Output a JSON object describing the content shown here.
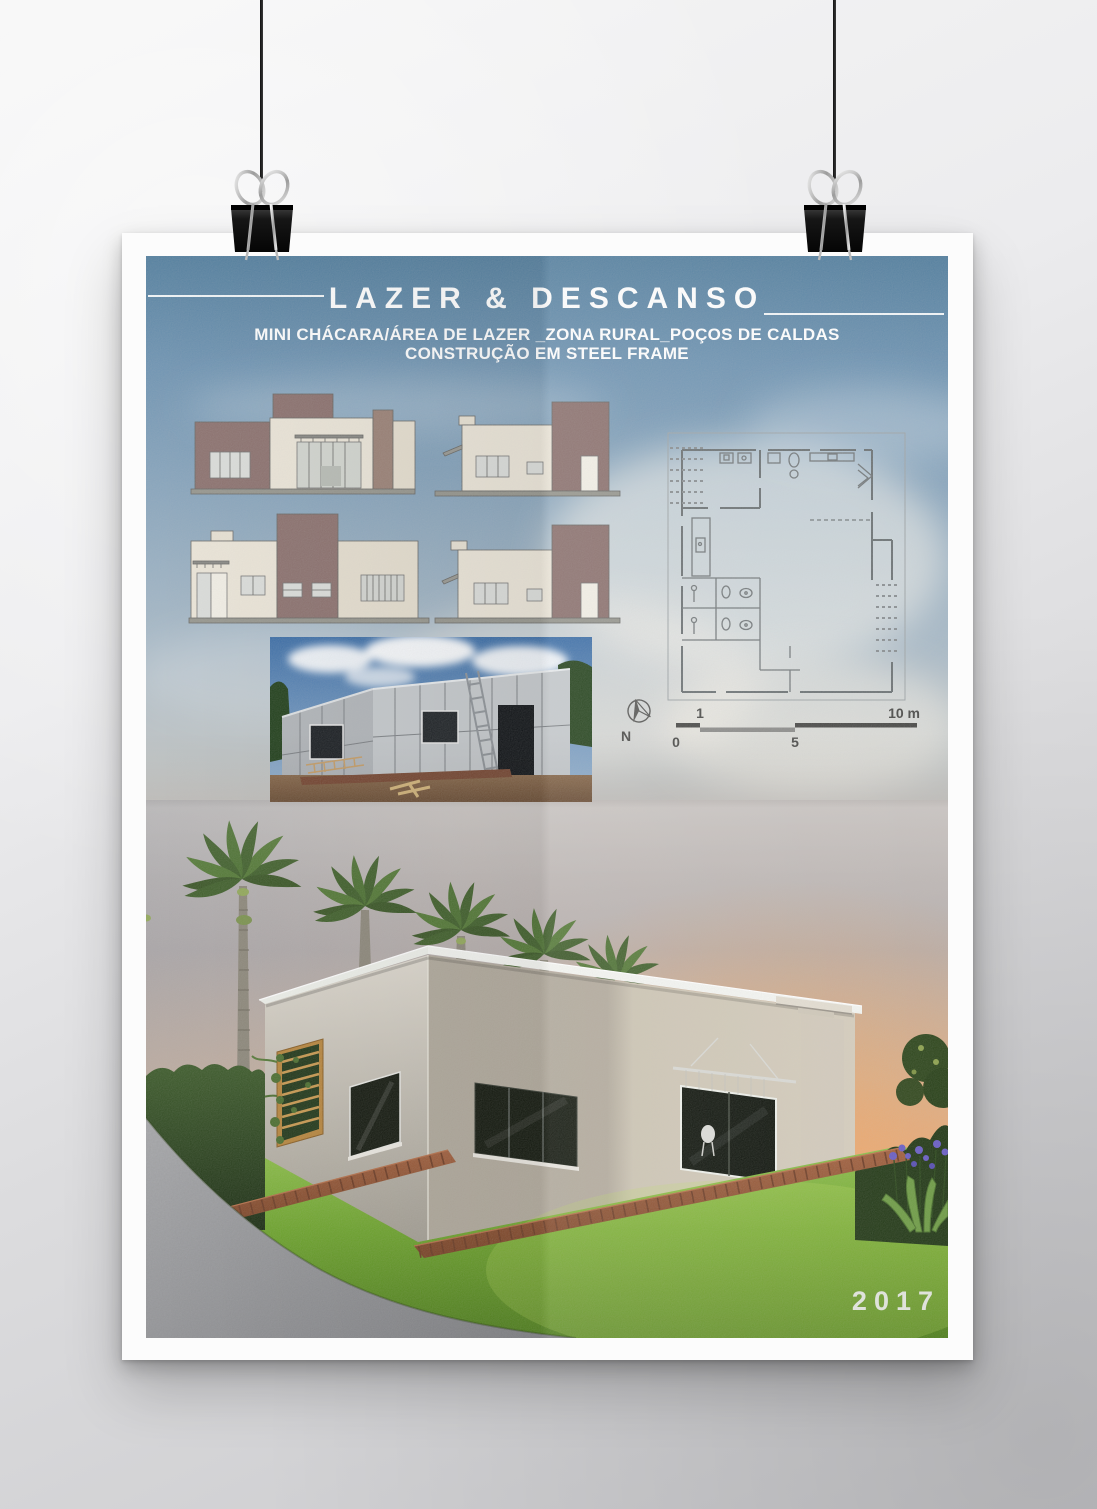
{
  "poster": {
    "title": "LAZER & DESCANSO",
    "subtitle_line1": "MINI CHÁCARA/ÁREA DE LAZER _ZONA RURAL_POÇOS DE CALDAS",
    "subtitle_line2": "CONSTRUÇÃO EM STEEL FRAME",
    "year": "2017"
  },
  "plan_key": {
    "compass_label": "N",
    "scale_bar": {
      "above_left": "1",
      "above_right": "10 m",
      "below_left": "0",
      "below_mid": "5"
    }
  },
  "palette": {
    "sky_top": "#5a85ab",
    "sunset_orange": "#f2a36b",
    "elevation_cream": "#ece6d9",
    "elevation_brown": "#8d7370",
    "grass_green": "#6ea42e",
    "deck_wood": "#96583b",
    "gravel_gray": "#9b9ca0",
    "title_white": "#ffffff"
  },
  "icons": {
    "binder_clip": "binder-clip-icon",
    "north_compass": "north-arrow-icon"
  }
}
